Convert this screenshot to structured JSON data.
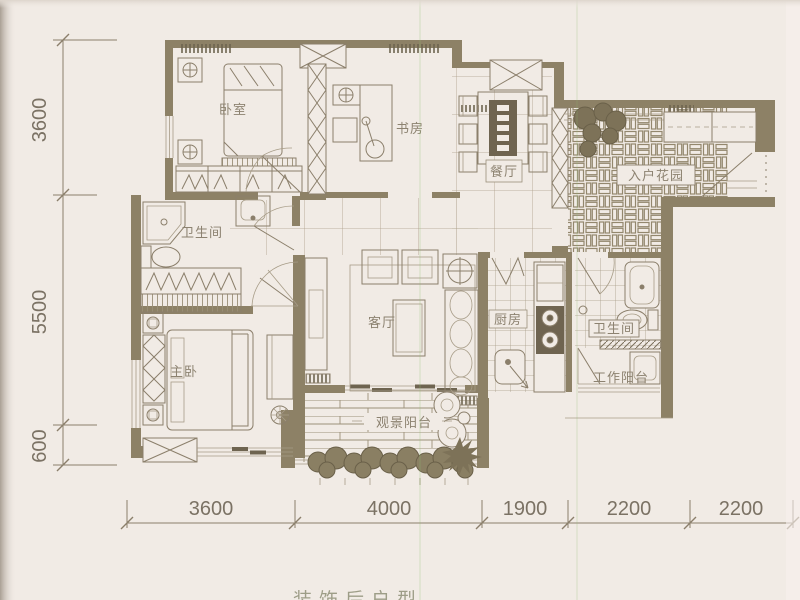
{
  "caption": {
    "bottom": "装饰后户型"
  },
  "rooms": {
    "bedroom": "卧室",
    "study": "书房",
    "dining": "餐厅",
    "entrance_garden": "入户花园",
    "bath1": "卫生间",
    "living": "客厅",
    "kitchen": "厨房",
    "bath2": "卫生间",
    "work_balcony": "工作阳台",
    "master_bedroom": "主卧",
    "view_balcony": "观景阳台"
  },
  "dimensions": {
    "left": [
      {
        "label": "3600"
      },
      {
        "label": "5500"
      },
      {
        "label": "600"
      }
    ],
    "bottom": [
      {
        "label": "3600"
      },
      {
        "label": "4000"
      },
      {
        "label": "1900"
      },
      {
        "label": "2200"
      },
      {
        "label": "2200"
      }
    ]
  },
  "colors": {
    "paper": "#f1ebe5",
    "wall": "#8d8166",
    "line": "#8b7f6b",
    "tile_line": "#a89d88",
    "label_text": "#8c8270",
    "dimension_text": "#7b7264",
    "caption_text": "#8f9077",
    "plant": "#7d7258"
  }
}
